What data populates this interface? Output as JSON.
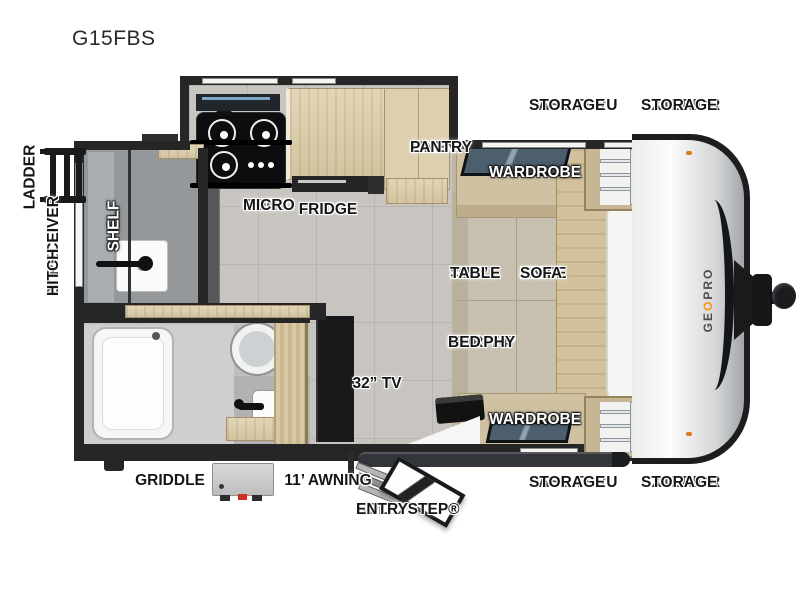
{
  "title": "G15FBS",
  "brand": {
    "logo_ge": "GE",
    "logo_o": "O",
    "logo_pro": "PRO",
    "accent_color": "#f7941d"
  },
  "labels": {
    "pass_thru_storage": [
      "PASS THRU",
      "STORAGE"
    ],
    "exterior_storage": [
      "EXTERIOR",
      "STORAGE"
    ],
    "linen_pantry": [
      "LINEN/",
      "PANTRY"
    ],
    "wardrobe": "WARDROBE",
    "conv_micro": [
      "CONV",
      "MICRO"
    ],
    "fridge": "FRIDGE",
    "table": [
      "30”",
      "× 15”",
      "TABLE"
    ],
    "jack_knife_sofa": [
      "JACK",
      "KNIFE",
      "SOFA"
    ],
    "murphy_bed": [
      "54” × 74”",
      "MURPHY",
      "BED"
    ],
    "tv": "32” TV",
    "shelf": "SHELF",
    "ladder": "LADDER",
    "receiver_hitch": [
      "2” RECEIVER",
      "HITCH"
    ],
    "griddle": "GRIDDLE",
    "awning": "11’ AWNING",
    "solid_step_entry": [
      "SOLID STEP®",
      "ENTRY"
    ]
  }
}
